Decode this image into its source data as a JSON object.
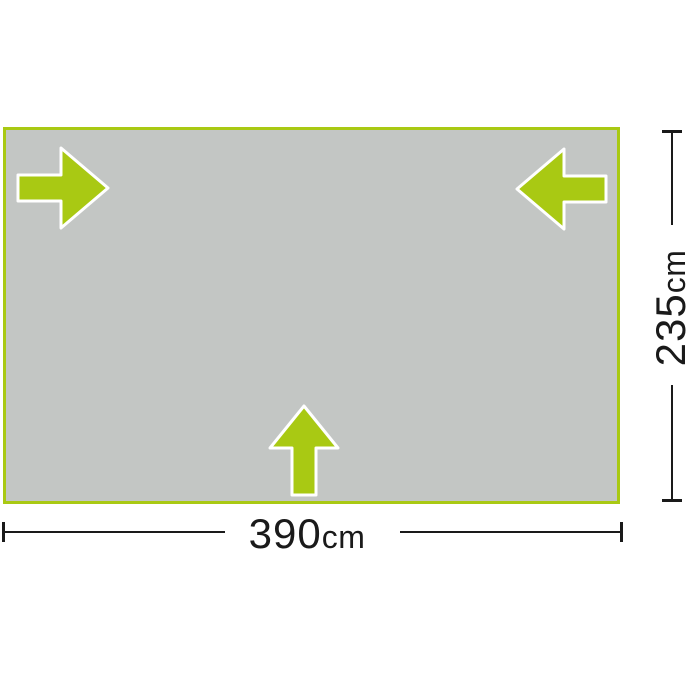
{
  "diagram": {
    "type": "product-dimension-diagram",
    "groundsheet": {
      "fill_color": "#c3c6c4",
      "border_color": "#a9c913"
    },
    "arrows": {
      "color": "#a9c913",
      "outline_color": "#ffffff",
      "items": [
        {
          "direction": "right",
          "position": "top-left"
        },
        {
          "direction": "left",
          "position": "top-right"
        },
        {
          "direction": "up",
          "position": "bottom-center"
        }
      ]
    },
    "dimensions": {
      "line_color": "#1a1a1a",
      "width": {
        "value": "390",
        "unit": "cm",
        "label": "390cm"
      },
      "height": {
        "value": "235",
        "unit": "cm",
        "label": "235cm"
      }
    }
  }
}
